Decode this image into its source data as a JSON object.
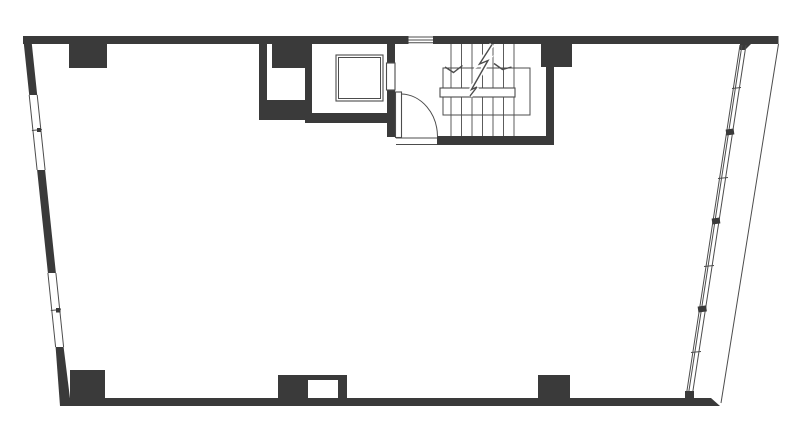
{
  "colors": {
    "background": "#ffffff",
    "wall": "#3a3a3a",
    "line": "#4c4c4c",
    "line_soft": "#5c5c5c"
  },
  "plan": {
    "drawing_type": "architectural-floor-plan",
    "features": [
      "perimeter-walls",
      "ribbon-window-left-upper",
      "ribbon-window-left-lower",
      "ribbon-window-right",
      "top-wall-window",
      "stairwell-with-break-line",
      "stair-handrail",
      "elevator-shaft-with-car",
      "elevator-door",
      "entry-door-with-swing-arc",
      "service-niche",
      "structural-piers",
      "duct-chase-opening"
    ]
  }
}
